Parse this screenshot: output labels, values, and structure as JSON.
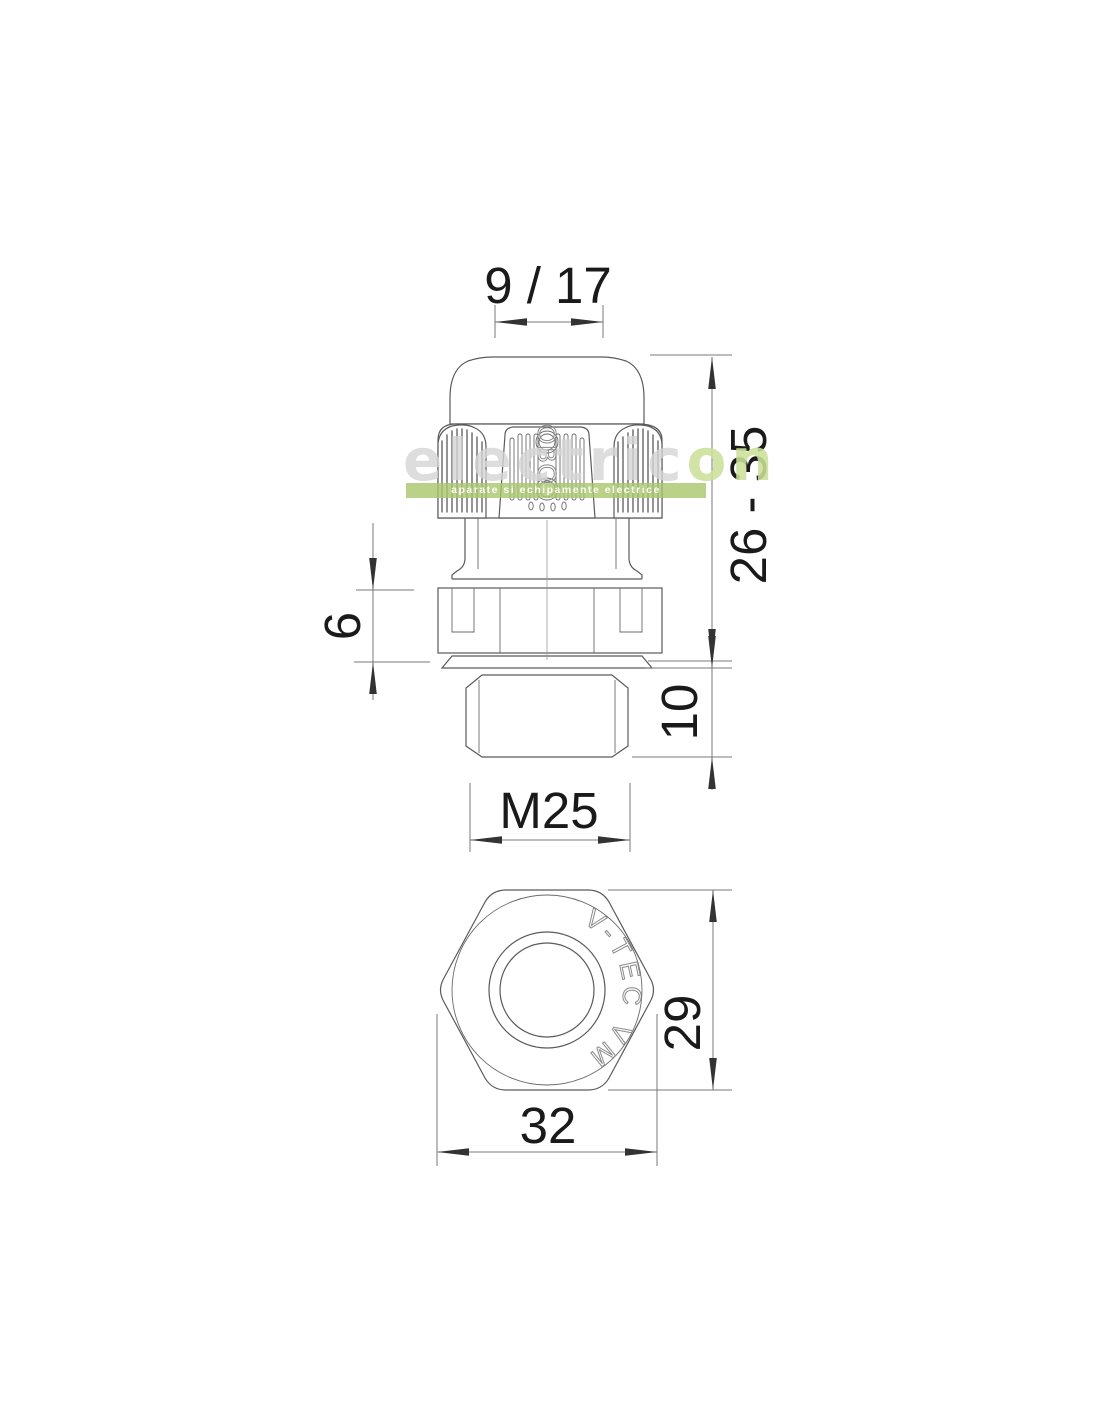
{
  "dims": {
    "cable_range": "9 / 17",
    "overall_height": "26 - 35",
    "collar_height": "6",
    "thread_length": "10",
    "thread_size": "M25",
    "across_flats": "29",
    "across_corners": "32"
  },
  "markings": {
    "brand": "OBO",
    "series": "V-TEC VM"
  },
  "watermark": {
    "brand_gray": "electric",
    "brand_green": "on",
    "tagline": "aparate si echipamente electrice"
  },
  "colors": {
    "part_line": "#5a5a5a",
    "dim_line": "#7a7a7a",
    "arrow": "#333333",
    "dim_text": "#1a1a1a",
    "watermark_gray": "#d5d5d5",
    "watermark_green": "#cbdf99",
    "band_green": "#a8c66c",
    "background": "#ffffff"
  }
}
